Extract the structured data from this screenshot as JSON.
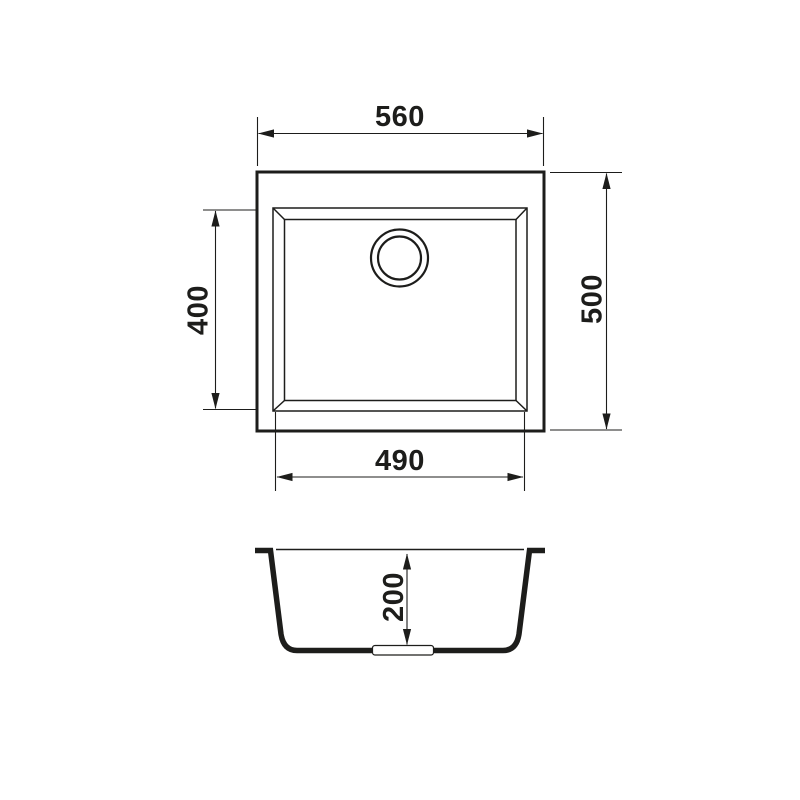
{
  "page": {
    "background": "#ffffff"
  },
  "drawing": {
    "kind": "technical-drawing",
    "subject": "single-bowl-kitchen-sink",
    "line_color": "#1d1d1b",
    "views": {
      "top": {
        "name": "top-view",
        "dimensions": {
          "overall_width": "560",
          "overall_depth": "500",
          "bowl_width": "490",
          "bowl_depth": "400"
        }
      },
      "section": {
        "name": "front-section-view",
        "dimensions": {
          "bowl_height": "200"
        }
      }
    }
  }
}
